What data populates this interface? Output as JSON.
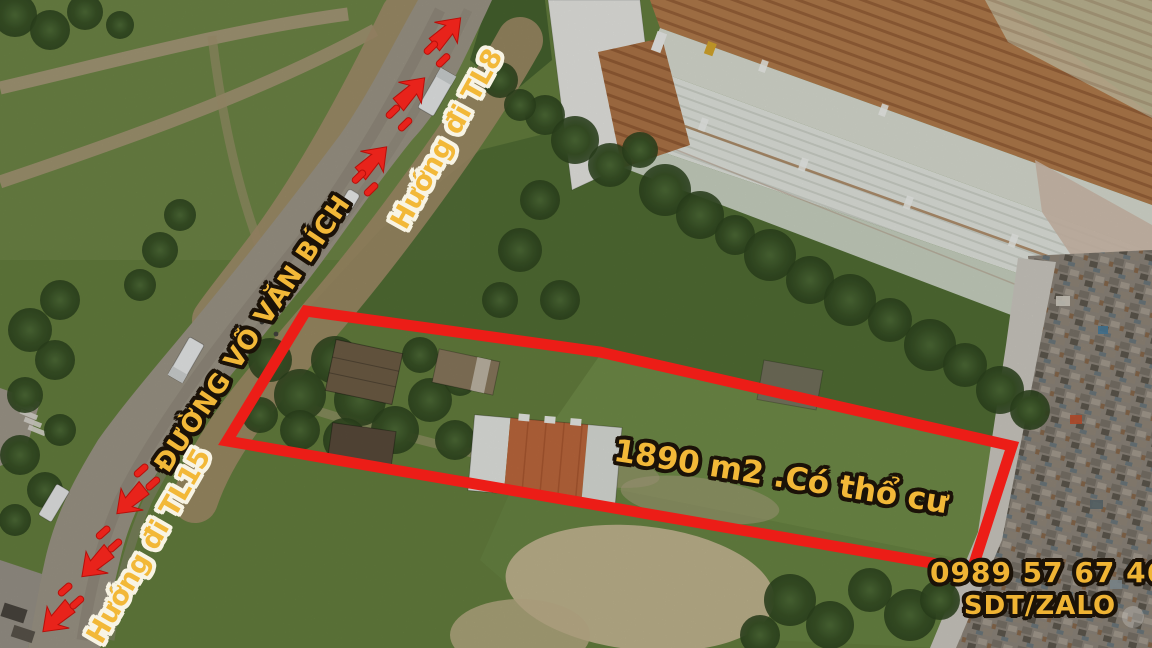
{
  "photo": {
    "type": "aerial-drone-photo",
    "subject": "Land plot for sale beside Vo Van Bich road, bordered in red, warehouses and scrapyard nearby"
  },
  "annotations": {
    "road_name": "ĐƯỜNG VÕ VĂN BÍCH",
    "direction_north_label": "Hướng đi TL8",
    "direction_south_label": "Hướng đi TL15",
    "plot_label": "1890 m2 .Có thổ cư",
    "plot_area_m2": "1890",
    "phone_number": "0989 57 67 46",
    "contact_channel": "SDT/ZALO",
    "boundary_points": "306,311 600,352 1012,446 972,570 227,441"
  },
  "colors": {
    "label_gold": "#f2b838",
    "annotation_red": "#e8231b",
    "outline_black": "#1b1208",
    "outline_white": "#f8f4e4"
  }
}
